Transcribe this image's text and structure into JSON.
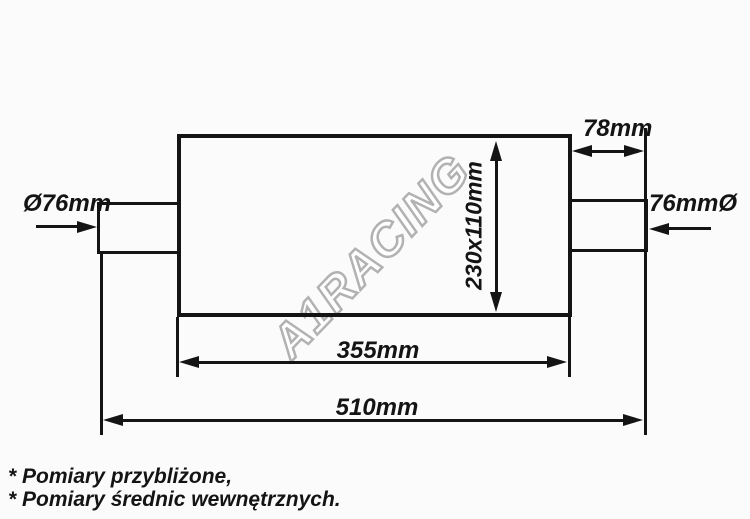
{
  "labels": {
    "inlet_diameter": "Ø76mm",
    "outlet_diameter": "76mmØ",
    "outlet_stub_length": "78mm",
    "body_cross_section": "230x110mm",
    "body_length": "355mm",
    "overall_length": "510mm"
  },
  "watermark": "A1RACING",
  "notes": {
    "line1": "* Pomiary przybliżone,",
    "line2": "* Pomiary średnic wewnętrznych."
  },
  "colors": {
    "line": "#141414",
    "background": "#fbfbfb",
    "watermark_fill": "#ffffff",
    "watermark_outline": "#b2b2b2"
  }
}
